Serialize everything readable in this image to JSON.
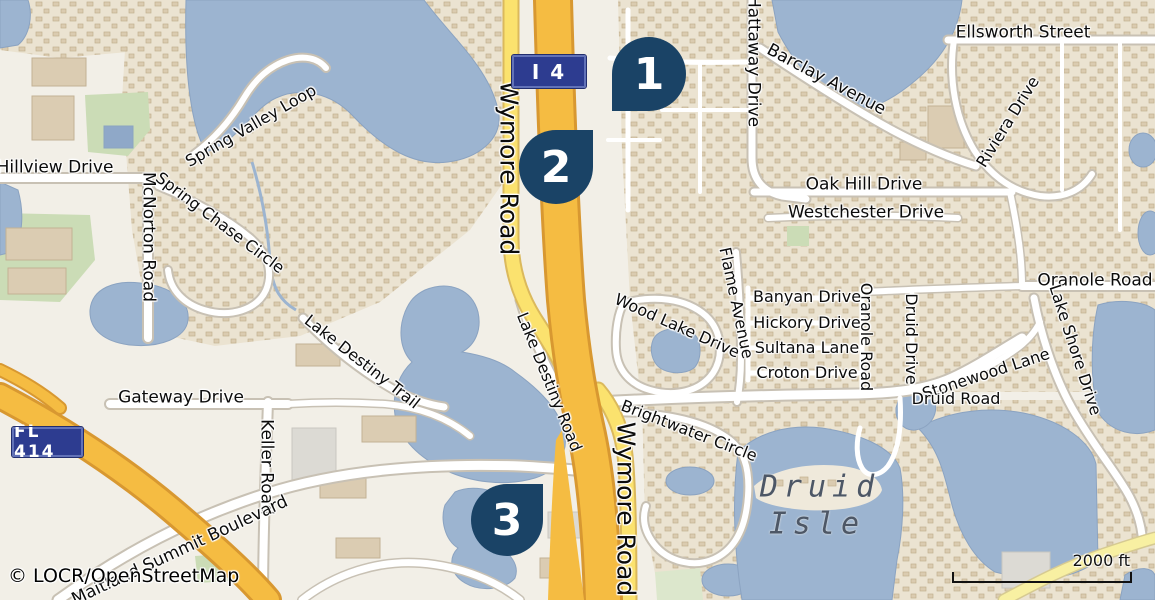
{
  "map": {
    "attribution": "© LOCR/OpenStreetMap",
    "scale_bar": {
      "label": "2000 ft"
    },
    "shields": [
      {
        "name": "interstate-4",
        "label": "I 4"
      },
      {
        "name": "florida-414",
        "label": "FL 414"
      }
    ],
    "markers": [
      {
        "number": "1"
      },
      {
        "number": "2"
      },
      {
        "number": "3"
      }
    ],
    "place_labels": [
      {
        "text": "Druid"
      },
      {
        "text": "Isle"
      }
    ],
    "road_labels": [
      {
        "text": "Hillview Drive"
      },
      {
        "text": "McNorton Road"
      },
      {
        "text": "Spring Valley Loop"
      },
      {
        "text": "Spring Chase Circle"
      },
      {
        "text": "Gateway Drive"
      },
      {
        "text": "Keller Road"
      },
      {
        "text": "Maitland Summit Boulevard"
      },
      {
        "text": "Lake Destiny Trail"
      },
      {
        "text": "Lake Destiny Road"
      },
      {
        "text": "Wymore Road"
      },
      {
        "text": "Wymore Road"
      },
      {
        "text": "Hattaway Drive"
      },
      {
        "text": "Barclay Avenue"
      },
      {
        "text": "Ellsworth Street"
      },
      {
        "text": "Riviera Drive"
      },
      {
        "text": "Oak Hill Drive"
      },
      {
        "text": "Westchester Drive"
      },
      {
        "text": "Oranole Road"
      },
      {
        "text": "Oranole Road"
      },
      {
        "text": "Druid Drive"
      },
      {
        "text": "Banyan Drive"
      },
      {
        "text": "Hickory Drive"
      },
      {
        "text": "Sultana Lane"
      },
      {
        "text": "Croton Drive"
      },
      {
        "text": "Flame Avenue"
      },
      {
        "text": "Wood Lake Drive"
      },
      {
        "text": "Stonewood Lane"
      },
      {
        "text": "Druid Road"
      },
      {
        "text": "Lake Shore Drive"
      },
      {
        "text": "Brightwater Circle"
      }
    ],
    "colors": {
      "water": "#9CB4D0",
      "land": "#F2EFE7",
      "residential": "#EBE3D1",
      "green": "#CBDCB6",
      "motorway": "#F5BC42",
      "secondary_road": "#FBE26E",
      "marker": "#1A4366",
      "shield": "#2D3C90"
    }
  }
}
